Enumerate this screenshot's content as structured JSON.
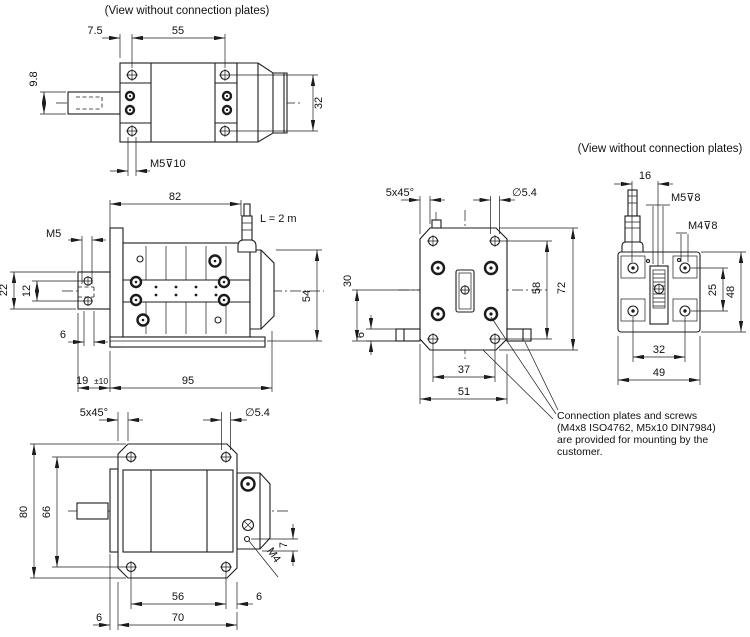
{
  "colors": {
    "line": "#1c1c1c",
    "background": "#ffffff"
  },
  "titles": {
    "view_side": "(View without connection plates)",
    "view_rear": "(View without connection plates)"
  },
  "note": {
    "line1": "Connection plates and screws",
    "line2": "(M4x8  ISO4762, M5x10 DIN7984)",
    "line3": "are provided for mounting by the",
    "line4": "customer."
  },
  "view_side": {
    "dim_7_5": "7.5",
    "dim_55": "55",
    "dim_9_8": "9.8",
    "dim_32": "32",
    "thread_label": "M5⊽10"
  },
  "view_top": {
    "dim_82": "82",
    "cable_label": "L = 2 m",
    "thread_label": "M5",
    "dim_22": "22",
    "dim_12": "12",
    "dim_6": "6",
    "dim_54": "54",
    "dim_19": "19",
    "dim_19_tol": "±10",
    "dim_95": "95"
  },
  "view_front": {
    "chamfer_label": "5x45°",
    "dia_label": "∅5.4",
    "dim_80": "80",
    "dim_66": "66",
    "dim_56": "56",
    "dim_6_right": "6",
    "dim_70": "70",
    "dim_6_left": "6",
    "dim_7": "7",
    "thread_label": "M4"
  },
  "view_plate": {
    "chamfer_label": "5x45°",
    "dia_label": "∅5.4",
    "dim_58": "58",
    "dim_72": "72",
    "dim_30": "30",
    "dim_6": "6",
    "dim_37": "37",
    "dim_51": "51"
  },
  "view_rear": {
    "dim_16": "16",
    "thread_m5": "M5⊽8",
    "thread_m4": "M4⊽8",
    "dim_25": "25",
    "dim_48": "48",
    "dim_32": "32",
    "dim_49": "49"
  }
}
